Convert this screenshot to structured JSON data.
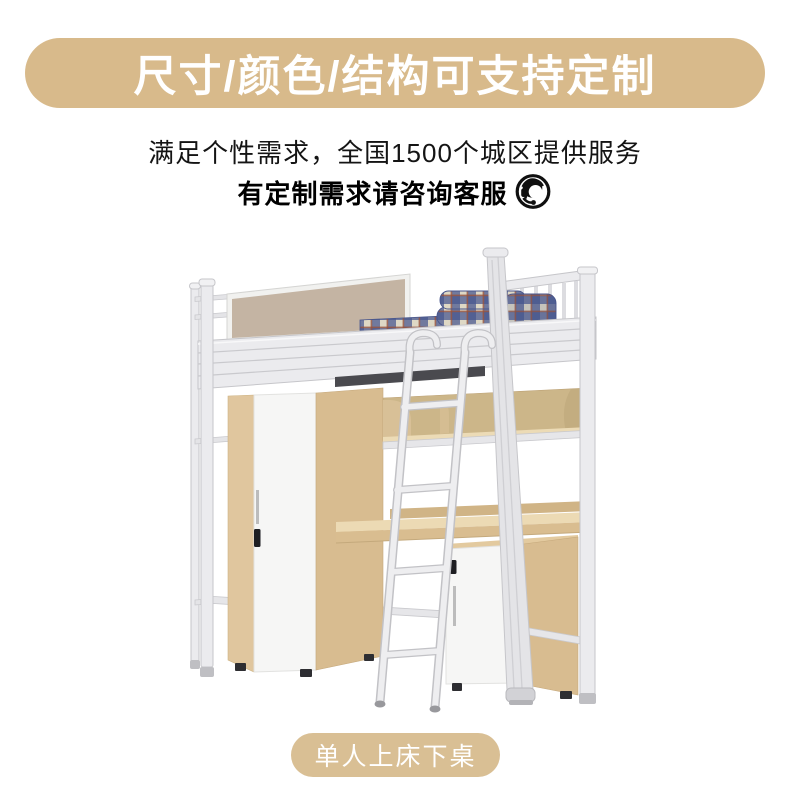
{
  "banner": {
    "title": "尺寸/颜色/结构可支持定制",
    "bg_color": "#d8ba8b",
    "text_color": "#ffffff"
  },
  "intro": {
    "line1": "满足个性需求，全国1500个城区提供服务",
    "line2": "有定制需求请咨询客服",
    "icon": "customer-service-headset-icon",
    "text_color": "#141414"
  },
  "product": {
    "illustration": "loft-bed-with-privacy-screen-wardrobe-shelf-desk-cabinet-ladder",
    "palette": {
      "metal_frame": "#ebebee",
      "wood_light": "#ecdab4",
      "wood_main": "#e0c69e",
      "wood_side": "#d8bc90",
      "panel_white": "#f6f6f5",
      "screen_tan": "#c4b4a3",
      "bedding_navy": "#47568f",
      "bedding_cream": "#ded8c5",
      "bedding_red": "#94503c"
    }
  },
  "badge": {
    "label": "单人上床下桌",
    "bg_color": "#d9bf94",
    "text_color": "#ffffff"
  }
}
